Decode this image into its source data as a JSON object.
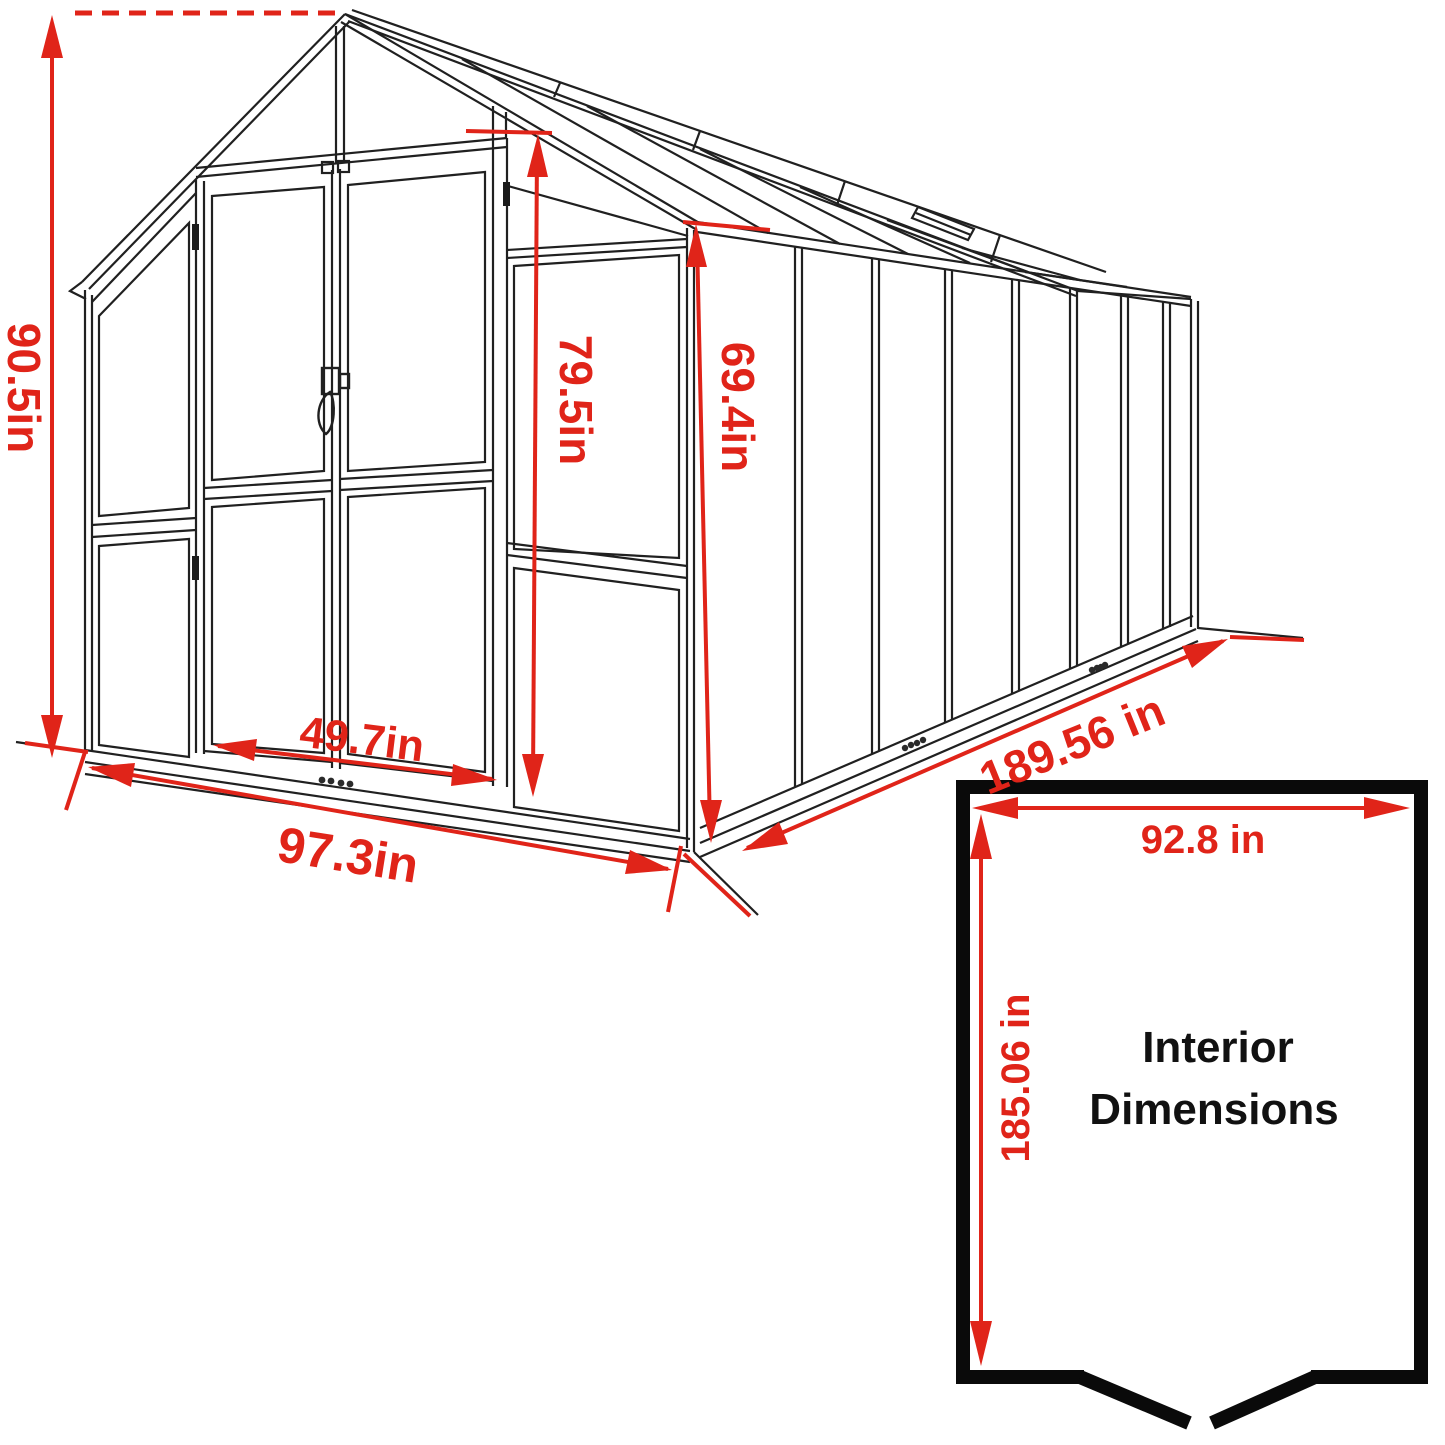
{
  "diagram": {
    "type": "greenhouse-dimension-drawing",
    "dimensions": {
      "overall_height": "90.5in",
      "door_height": "79.5in",
      "wall_height": "69.4in",
      "door_width": "49.7in",
      "front_width": "97.3in",
      "side_length": "189.56 in"
    },
    "interior_box": {
      "width": "92.8 in",
      "length": "185.06 in",
      "title_line1": "Interior",
      "title_line2": "Dimensions"
    },
    "colors": {
      "dimension_red": "#e02419",
      "line_black": "#202020",
      "box_black": "#0a0a0a"
    }
  }
}
